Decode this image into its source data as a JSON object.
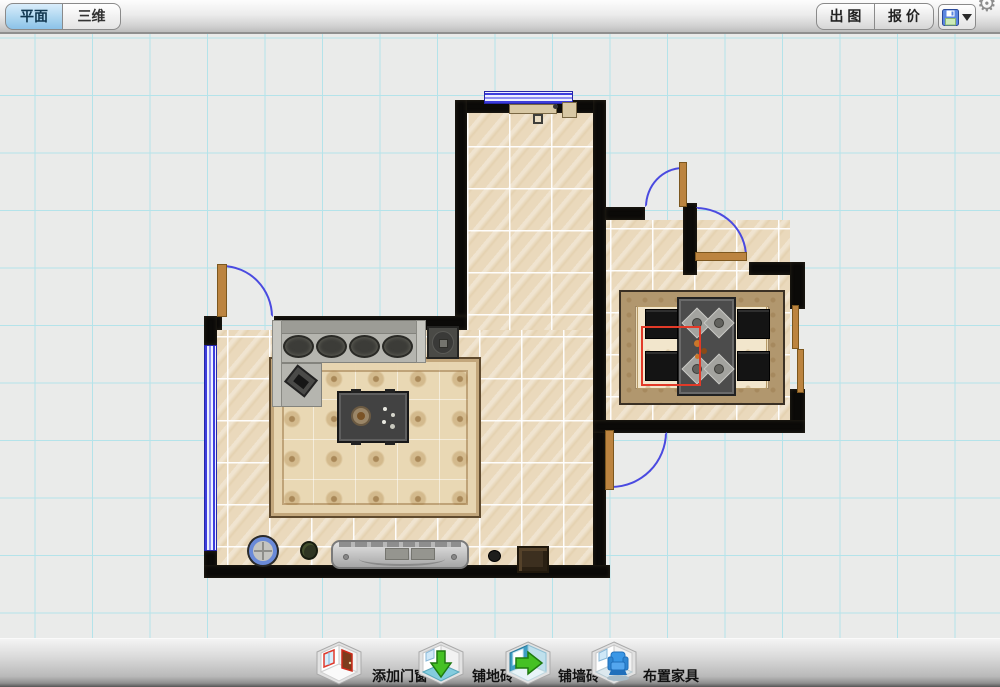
{
  "titlebar": {
    "tabs": [
      {
        "label": "平面",
        "active": true
      },
      {
        "label": "三维",
        "active": false
      }
    ],
    "export_button": "出 图",
    "quote_button": "报 价",
    "save_icon": "floppy-disk",
    "save_dropdown_icon": "caret-down",
    "settings_icon": "gear"
  },
  "bottom_toolbar": {
    "items": [
      {
        "icon": "room-door-window-icon",
        "label": "添加门窗"
      },
      {
        "icon": "room-floor-tile-icon",
        "label": "铺地砖"
      },
      {
        "icon": "room-wall-tile-icon",
        "label": "铺墙砖"
      },
      {
        "icon": "room-furniture-icon",
        "label": "布置家具"
      }
    ]
  },
  "canvas": {
    "grid_color": "#b4e3ea",
    "background_color": "#eaebea",
    "wall_color": "#0b0a08",
    "floor_tile_color": "#ead9bc",
    "door_color": "#bc8440",
    "window_color": "#3d3ddc",
    "selection_color": "#e23a28"
  }
}
